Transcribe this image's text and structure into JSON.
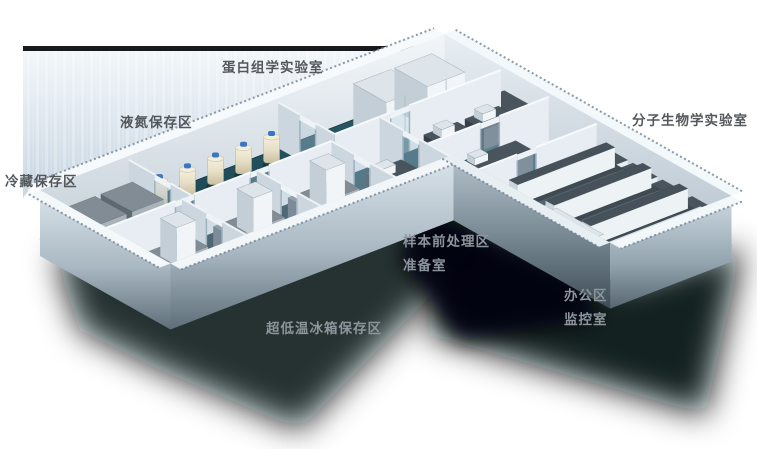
{
  "scene": {
    "type": "isometric-lab-floorplan",
    "areas": [
      {
        "id": "proteomics_lab",
        "label": "蛋白组学实验室"
      },
      {
        "id": "liquid_nitrogen_storage",
        "label": "液氮保存区"
      },
      {
        "id": "cold_storage",
        "label": "冷藏保存区"
      },
      {
        "id": "molecular_biology_lab",
        "label": "分子生物学实验室"
      },
      {
        "id": "sample_preprocessing",
        "label": "样本前处理区"
      },
      {
        "id": "prep_room",
        "label": "准备室"
      },
      {
        "id": "office_area",
        "label": "办公区"
      },
      {
        "id": "monitoring_room",
        "label": "监控室"
      },
      {
        "id": "ult_freezer_storage",
        "label": "超低温冰箱保存区"
      }
    ],
    "colors": {
      "floor_teal": "#1d4955",
      "wall_white": "#f1f5f8",
      "backdrop_blue": "#c6d4e1",
      "shadow": "#05080c",
      "label_dark": "#54585c",
      "label_light": "#8d959c",
      "dewar_cream": "#e7dfc6",
      "dewar_cap_blue": "#3a77c2",
      "freezer_gray": "#828c94",
      "desk_dark": "#49545d",
      "bench_top": "#3f4a52"
    }
  }
}
